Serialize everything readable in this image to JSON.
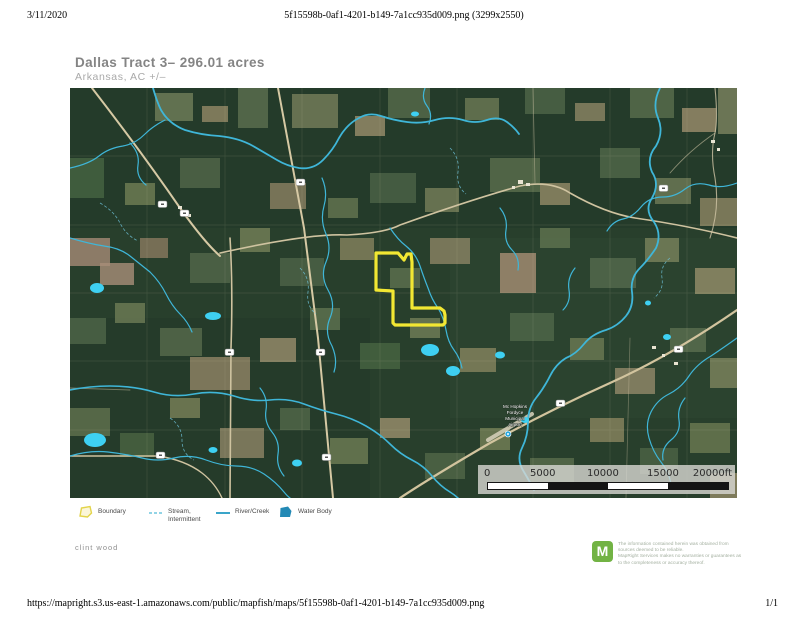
{
  "print_header": {
    "date": "3/11/2020",
    "filename": "5f15598b-0af1-4201-b149-7a1cc935d009.png (3299x2550)"
  },
  "title_block": {
    "title": "Dallas Tract 3– 296.01 acres",
    "subtitle": "Arkansas,  AC +/–"
  },
  "map": {
    "scale_bar": {
      "labels": [
        "0",
        "5000",
        "10000",
        "15000",
        "20000ft"
      ]
    },
    "airport_label": {
      "lines": [
        "Mc Hopkins",
        "Fordyce",
        "Municipal",
        "Airport"
      ]
    },
    "colors": {
      "boundary": "#f2e733",
      "stream": "#3fb6d8",
      "water_body": "#2389b5",
      "forest_base": "#283f2c",
      "road": "#d6c9a4"
    }
  },
  "legend": {
    "items": [
      {
        "label": "Boundary",
        "label2": "",
        "icon": "boundary-polygon-icon"
      },
      {
        "label": "Stream,",
        "label2": "Intermittent",
        "icon": "dashed-stream-line-icon"
      },
      {
        "label": "River/Creek",
        "label2": "",
        "icon": "river-line-icon"
      },
      {
        "label": "Water Body",
        "label2": "",
        "icon": "water-body-polygon-icon"
      }
    ]
  },
  "author": "clint wood",
  "brand": {
    "logo_letter": "M",
    "disclaimer_lines": [
      "The information contained herein was obtained from",
      "sources deemed to be reliable.",
      "MapRight Services makes no warranties or guarantees as",
      "to the completeness or accuracy thereof."
    ]
  },
  "print_footer": {
    "url": "https://mapright.s3.us-east-1.amazonaws.com/public/mapfish/maps/5f15598b-0af1-4201-b149-7a1cc935d009.png",
    "page": "1/1"
  }
}
